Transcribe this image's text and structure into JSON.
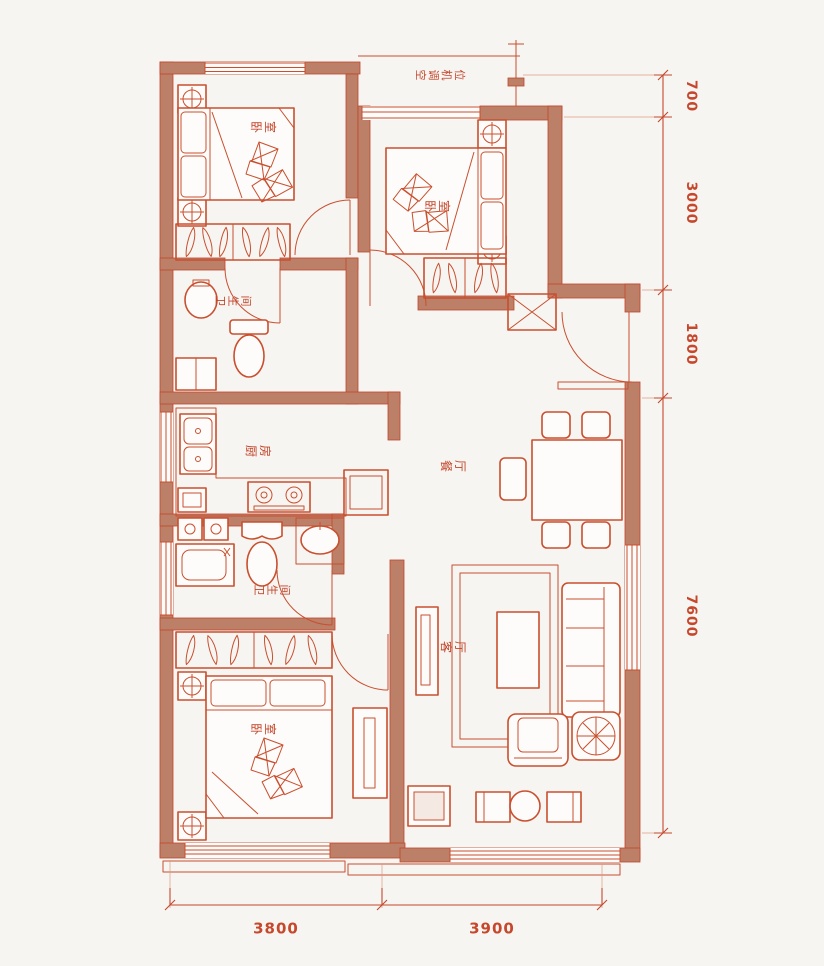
{
  "colors": {
    "bg": "#f7f5f2",
    "wall": "#bc7f68",
    "line": "#c94f2e",
    "line_strong": "#c2452a",
    "dim": "#c6472b",
    "label": "#c2452a",
    "light_fill": "#f5e9e3"
  },
  "rooms": {
    "equipment_platform": {
      "label": "空调机位"
    },
    "bedroom_top_left": {
      "label": "卧室"
    },
    "bedroom_top_right": {
      "label": "卧室"
    },
    "bath_upper": {
      "label": "卫生间"
    },
    "kitchen": {
      "label": "厨房"
    },
    "dining": {
      "label": "餐厅"
    },
    "bath_lower": {
      "label": "卫生间"
    },
    "living": {
      "label": "客厅"
    },
    "bedroom_bottom_left": {
      "label": "卧室"
    }
  },
  "dimensions": {
    "right": [
      "700",
      "3000",
      "1800",
      "7600"
    ],
    "bottom": [
      "3800",
      "3900"
    ]
  }
}
